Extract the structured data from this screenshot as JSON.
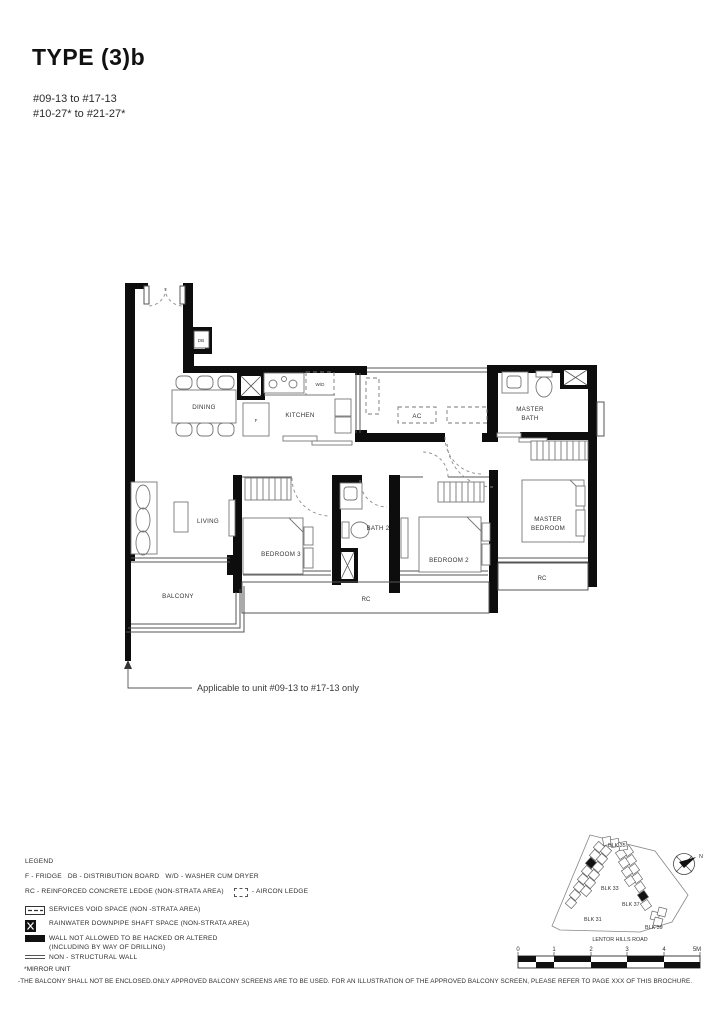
{
  "title": "TYPE (3)b",
  "unit_ranges": {
    "line1": "#09-13 to #17-13",
    "line2": "#10-27* to #21-27*"
  },
  "plan": {
    "labels": {
      "dining": "DINING",
      "kitchen": "KITCHEN",
      "living": "LIVING",
      "balcony": "BALCONY",
      "bedroom3": "BEDROOM 3",
      "bath2": "BATH 2",
      "bedroom2": "BEDROOM 2",
      "master1": "MASTER",
      "master2": "BEDROOM",
      "mbath1": "MASTER",
      "mbath2": "BATH",
      "ac": "AC",
      "db": "DB",
      "fridge": "F",
      "wd": "W/D",
      "rc": "RC"
    },
    "annotation": "Applicable to unit #09-13 to #17-13 only"
  },
  "legend": {
    "heading": "LEGEND",
    "abbrev_line": "F - FRIDGE   DB - DISTRIBUTION BOARD   W/D - WASHER CUM DRYER",
    "rc_line": "RC - REINFORCED CONCRETE LEDGE (NON-STRATA AREA)    ",
    "aircon_label": " - AIRCON LEDGE",
    "items": [
      {
        "icon": "services-void-icon",
        "label": "SERVICES VOID SPACE (NON -STRATA AREA)"
      },
      {
        "icon": "rainwater-downpipe-icon",
        "label": "RAINWATER DOWNPIPE SHAFT SPACE (NON-STRATA AREA)"
      },
      {
        "icon": "no-hack-wall-icon",
        "label": "WALL NOT ALLOWED TO BE HACKED OR ALTERED",
        "label2": "(INCLUDING BY WAY OF DRILLING)"
      },
      {
        "icon": "non-structural-wall-icon",
        "label": "NON - STRUCTURAL WALL"
      }
    ],
    "mirror_note": "*MIRROR UNIT"
  },
  "disclaimer": "-THE BALCONY SHALL NOT BE ENCLOSED.ONLY APPROVED BALCONY SCREENS ARE TO BE USED. FOR AN ILLUSTRATION OF THE APPROVED BALCONY SCREEN, PLEASE REFER TO PAGE XXX OF THIS BROCHURE.",
  "site_plan": {
    "blocks": [
      "BLK 35",
      "BLK 33",
      "BLK 31",
      "BLK 37",
      "BLK 39"
    ],
    "road": "LENTOR HILLS ROAD",
    "compass": "N"
  },
  "scale_bar": {
    "labels": [
      "0",
      "1",
      "2",
      "3",
      "4",
      "5M"
    ]
  }
}
